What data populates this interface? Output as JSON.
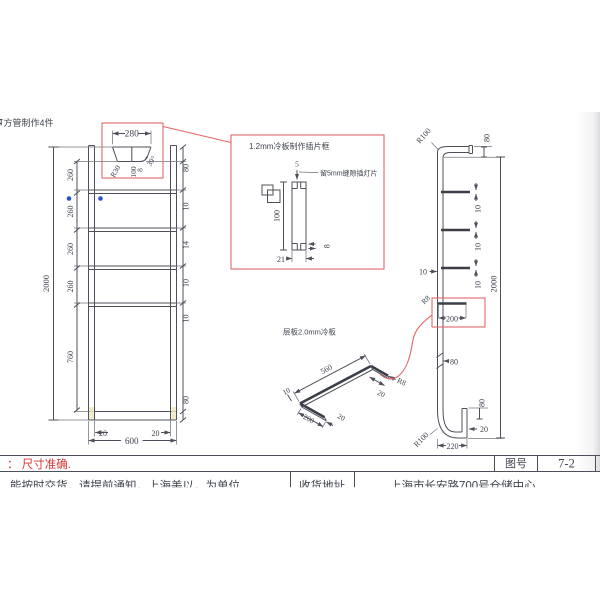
{
  "colors": {
    "line": "#4d505a",
    "red_accent": "#e06868",
    "red_text": "#d63434",
    "blue_marker": "#2b50c8"
  },
  "header": {
    "top_note": "方管制作4件"
  },
  "front_view": {
    "cap": {
      "width": "280",
      "radius": "R30",
      "height": "100",
      "lip": "8",
      "angle": "39°"
    },
    "right_chain": [
      "80",
      "10",
      "14",
      "10",
      "10",
      "80"
    ],
    "left_chain": [
      "260",
      "260",
      "260",
      "260",
      "760"
    ],
    "overall_height": "2000",
    "bottom_dims": [
      "20",
      "600",
      "20"
    ]
  },
  "detail_box": {
    "title": "1.2mm冷板制作插片框",
    "slot_width": "5",
    "slot_note": "留5mm缝隙插灯片",
    "height": "100",
    "width": "21",
    "thickness": "8"
  },
  "side_view": {
    "top_radius": "R100",
    "top_depth": "80",
    "overall_height": "2000",
    "stub_gaps": [
      "10",
      "10",
      "10"
    ],
    "left_gap": "10",
    "detail": {
      "radius": "R8",
      "length": "200"
    },
    "mid_offset": "80",
    "lip_height": "80",
    "lip_width": "20",
    "bottom_radius": "R100",
    "bottom_depth": "220"
  },
  "shelf_iso": {
    "title": "层板2.0mm冷板",
    "length": "560",
    "front_lip": "10",
    "depth": "200",
    "lip_left": "20",
    "lip_right": "20",
    "radius": "R8"
  },
  "footer": {
    "note_red": "： 尺寸准确.",
    "title_block": {
      "label": "图号",
      "value": "7-2"
    },
    "row": {
      "left": "能按时交货，请提前通知，上海美以，为单位",
      "mid": "收货地址",
      "right": "上海市长安路700号仓储中心"
    }
  }
}
